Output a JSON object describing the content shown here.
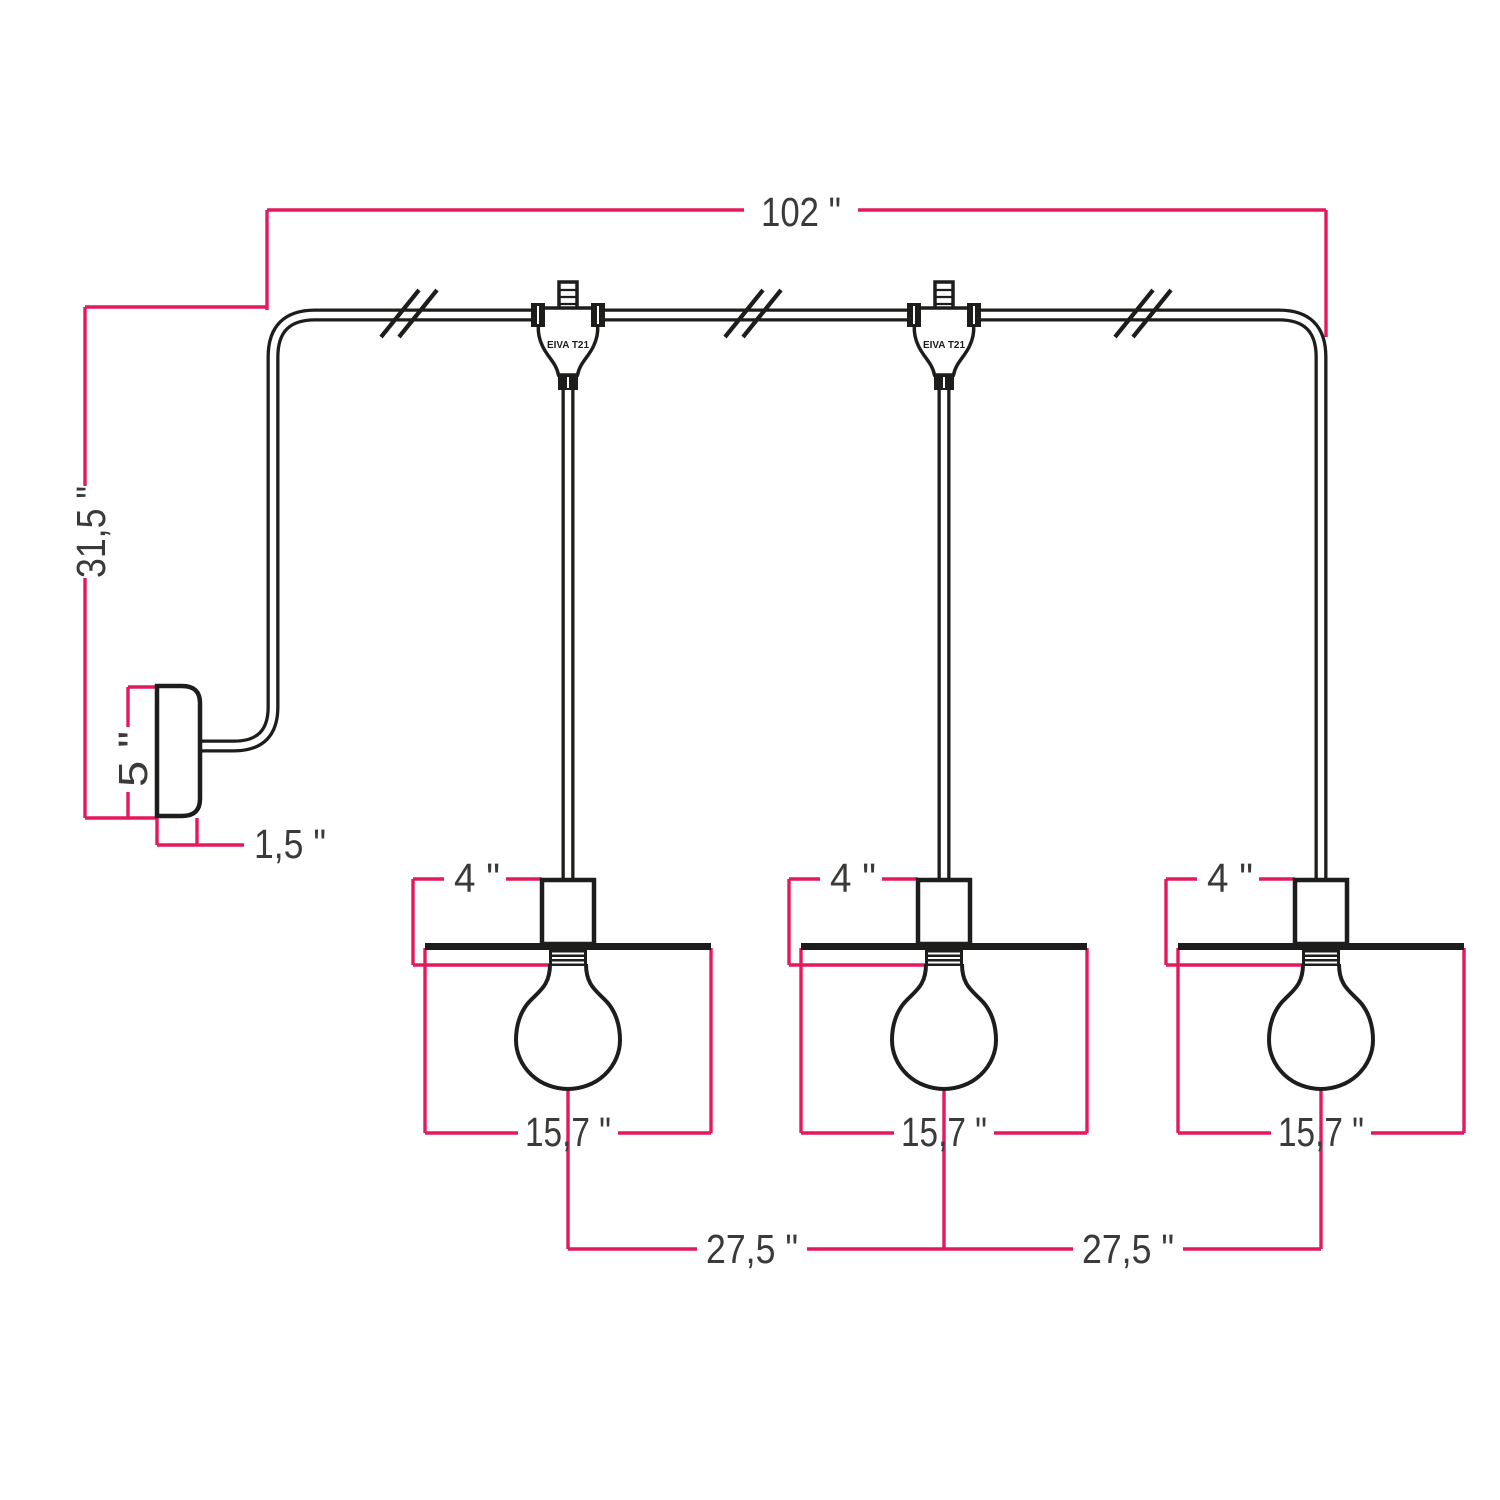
{
  "diagram": {
    "type": "technical-line-drawing",
    "subject": "3-light wall-mounted pendant lamp with dimension annotations",
    "colors": {
      "background": "#ffffff",
      "outline": "#1d1d1b",
      "dimension_line": "#e4185c",
      "dimension_text": "#3a3a38"
    },
    "labels": {
      "total_width": "102 \"",
      "wall_drop_height": "31,5 \"",
      "wall_plate_height": "5 \"",
      "wall_plate_depth": "1,5 \"",
      "socket_height": "4 \"",
      "shade_diameter": "15,7 \"",
      "spacing_left": "27,5 \"",
      "spacing_right": "27,5 \"",
      "connector_model": "EIVA T21"
    },
    "counts": {
      "pendants": 3,
      "t_connectors": 2,
      "cable_break_marks": 3
    }
  }
}
